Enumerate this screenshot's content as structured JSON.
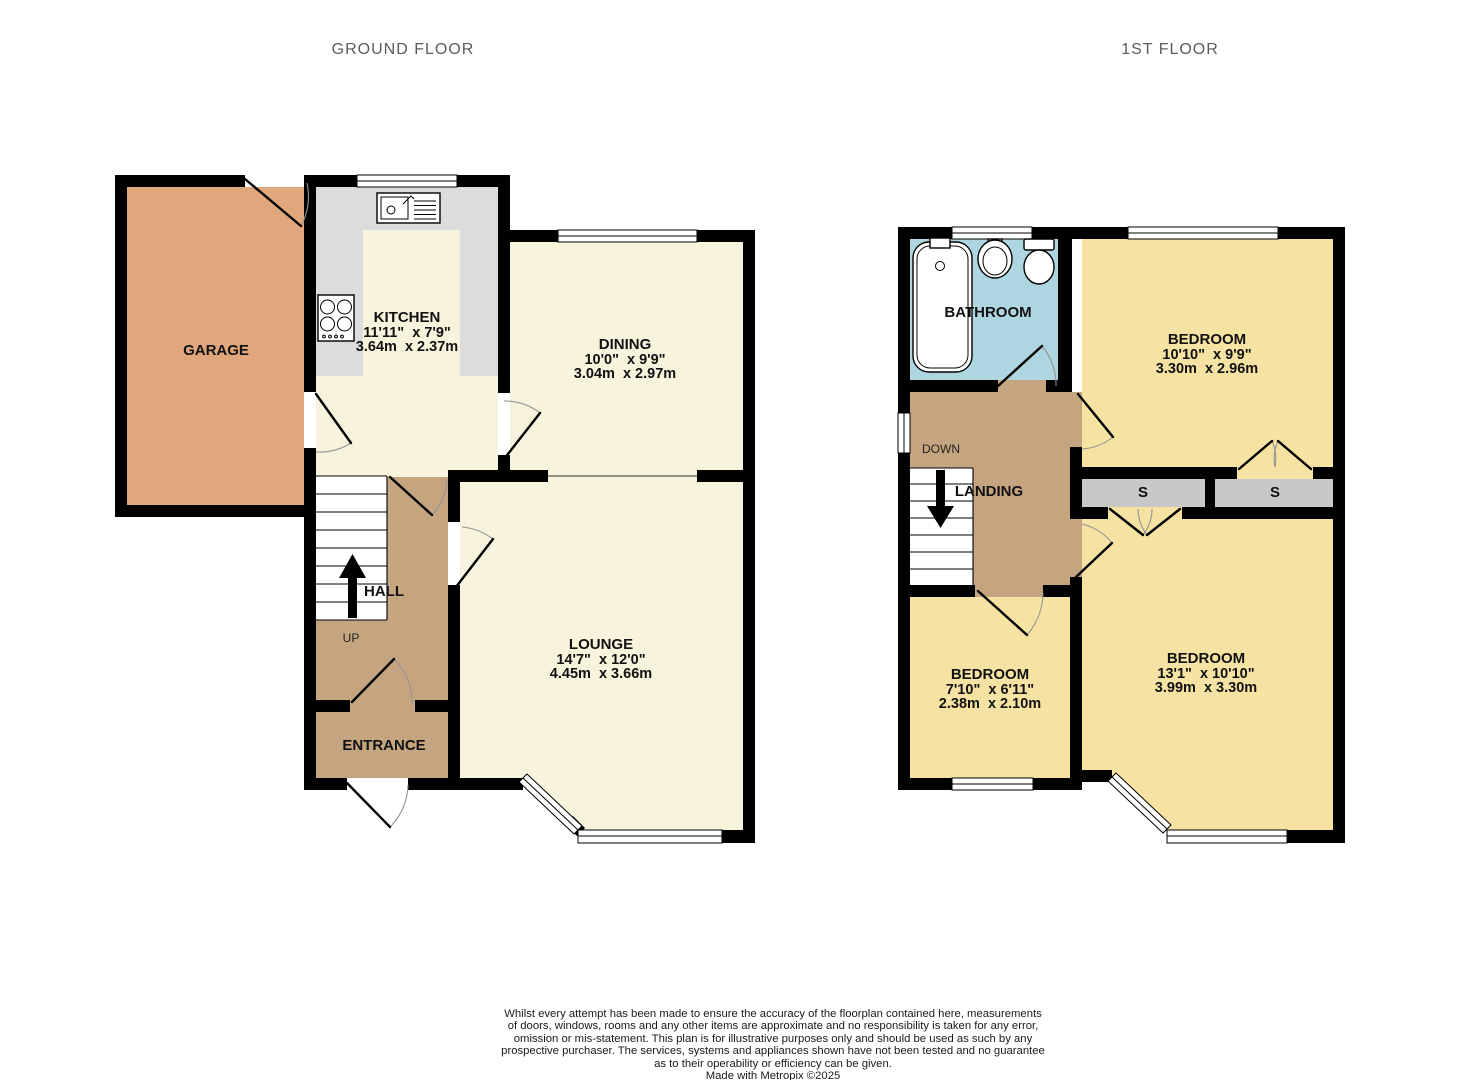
{
  "titles": {
    "ground": "GROUND FLOOR",
    "first": "1ST FLOOR"
  },
  "ground_floor": {
    "garage": {
      "name": "GARAGE"
    },
    "kitchen": {
      "name": "KITCHEN",
      "imperial": "11'11\"  x 7'9\"",
      "metric": "3.64m  x 2.37m"
    },
    "dining": {
      "name": "DINING",
      "imperial": "10'0\"  x 9'9\"",
      "metric": "3.04m  x 2.97m"
    },
    "lounge": {
      "name": "LOUNGE",
      "imperial": "14'7\"  x 12'0\"",
      "metric": "4.45m  x 3.66m"
    },
    "hall": {
      "name": "HALL",
      "up": "UP"
    },
    "entrance": {
      "name": "ENTRANCE"
    }
  },
  "first_floor": {
    "bathroom": {
      "name": "BATHROOM"
    },
    "bedroom_rear": {
      "name": "BEDROOM",
      "imperial": "10'10\"  x 9'9\"",
      "metric": "3.30m  x 2.96m"
    },
    "landing": {
      "name": "LANDING",
      "down": "DOWN"
    },
    "storage_left": {
      "label": "S"
    },
    "storage_right": {
      "label": "S"
    },
    "bedroom_small": {
      "name": "BEDROOM",
      "imperial": "7'10\"  x 6'11\"",
      "metric": "2.38m  x 2.10m"
    },
    "bedroom_front": {
      "name": "BEDROOM",
      "imperial": "13'1\"  x 10'10\"",
      "metric": "3.99m  x 3.30m"
    }
  },
  "disclaimer": {
    "line1": "Whilst every attempt has been made to ensure the accuracy of the floorplan contained here, measurements",
    "line2": "of doors, windows, rooms and any other items are approximate and no responsibility is taken for any error,",
    "line3": "omission or mis-statement. This plan is for illustrative purposes only and should be used as such by any",
    "line4": "prospective purchaser. The services, systems and appliances shown have not been tested and no guarantee",
    "line5": "as to their operability or efficiency can be given.",
    "credit": "Made with Metropix ©2025"
  },
  "colors": {
    "wall": "#000000",
    "cream": "#f8f3dc",
    "garage": "#e1a77c",
    "hall": "#c5a480",
    "bedroom": "#f6e2a2",
    "bathroom": "#aed6e0",
    "counter": "#dcdcdc",
    "storage": "#c8c8c8",
    "title": "#5c5c5e"
  }
}
